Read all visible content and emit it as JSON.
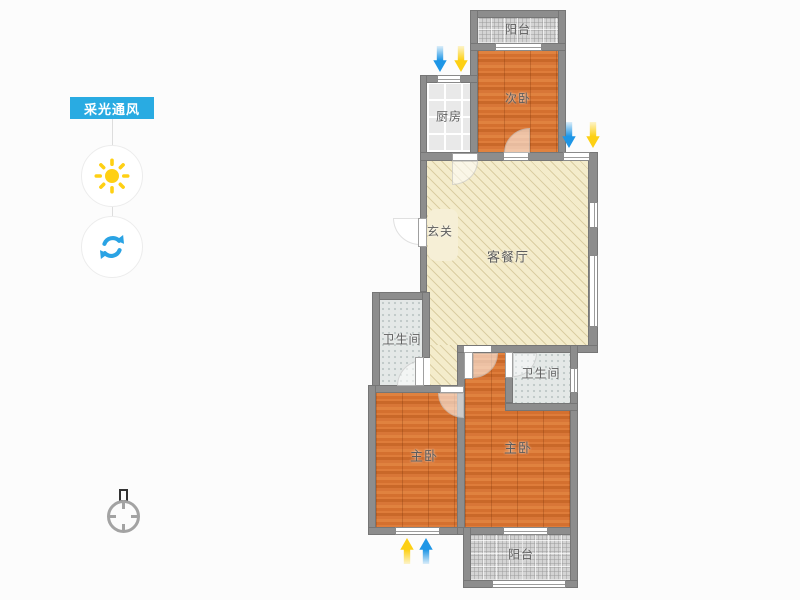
{
  "colors": {
    "accent_blue": "#29abe2",
    "sun_yellow": "#ffd013",
    "refresh_blue": "#2aa3e4",
    "arrow_blue": "#1e96e6",
    "arrow_yellow": "#fdd014",
    "wall_gray": "#8d8d8d"
  },
  "legend": {
    "badge_label": "采光通风",
    "sun_icon": "sun-icon",
    "refresh_icon": "refresh-icon"
  },
  "floorplan": {
    "rooms": {
      "balcony_top": "阳台",
      "bedroom_secondary": "次卧",
      "kitchen": "厨房",
      "entry": "玄关",
      "living_dining": "客餐厅",
      "bathroom_left": "卫生间",
      "bathroom_right": "卫生间",
      "master_left": "主卧",
      "master_right": "主卧",
      "balcony_bottom": "阳台"
    }
  }
}
